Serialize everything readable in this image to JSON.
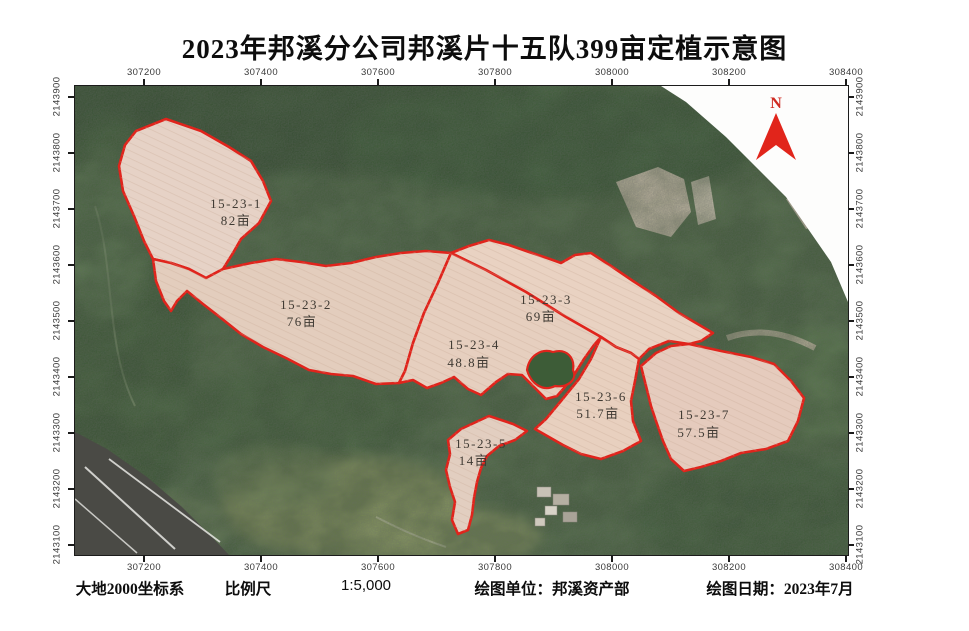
{
  "title": "2023年邦溪分公司邦溪片十五队399亩定植示意图",
  "north_indicator": {
    "label": "N"
  },
  "map": {
    "x_ticks": [
      "307200",
      "307400",
      "307600",
      "307800",
      "308000",
      "308200",
      "308400"
    ],
    "y_ticks": [
      "2143900",
      "2143800",
      "2143700",
      "2143600",
      "2143500",
      "2143400",
      "2143300",
      "2143200",
      "2143100"
    ],
    "parcels": [
      {
        "id": "15-23-1",
        "area": "82亩"
      },
      {
        "id": "15-23-2",
        "area": "76亩"
      },
      {
        "id": "15-23-3",
        "area": "69亩"
      },
      {
        "id": "15-23-4",
        "area": "48.8亩"
      },
      {
        "id": "15-23-5",
        "area": "14亩"
      },
      {
        "id": "15-23-6",
        "area": "51.7亩"
      },
      {
        "id": "15-23-7",
        "area": "57.5亩"
      }
    ]
  },
  "footer": {
    "crs": "大地2000坐标系",
    "scale_label": "比例尺",
    "scale_value": "1:5,000",
    "unit": "绘图单位：邦溪资产部",
    "date": "绘图日期：2023年7月"
  },
  "colors": {
    "parcel_outline": "#e0241c",
    "parcel_fill": "#e7d1c2",
    "forest_base": "#55714b",
    "north_arrow": "#e1251b"
  }
}
